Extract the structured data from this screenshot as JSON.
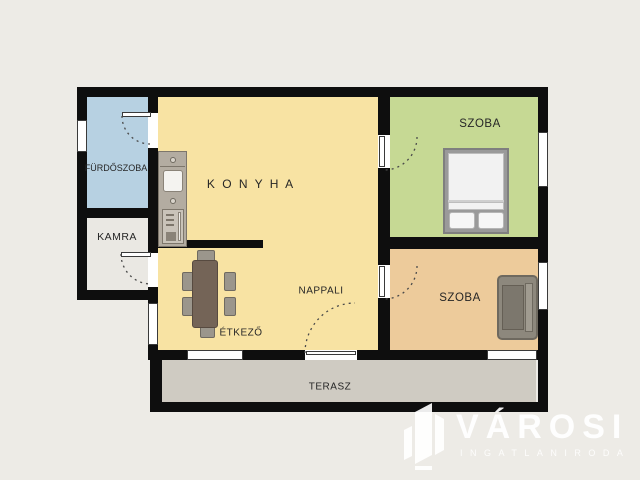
{
  "plan": {
    "type": "apartment-floorplan",
    "background_color": "#edebe6",
    "wall_color": "#0e0e0e",
    "rooms": [
      {
        "id": "furdoszoba",
        "label": "FÜRDŐSZOBA",
        "color": "#b7d1e2"
      },
      {
        "id": "kamra",
        "label": "KAMRA",
        "color": "#eae8e3"
      },
      {
        "id": "konyha",
        "label": "K O N Y H A",
        "color": "#f8e3a3"
      },
      {
        "id": "etkezo",
        "label": "ÉTKEZŐ",
        "color": "#f8e3a3"
      },
      {
        "id": "nappali",
        "label": "NAPPALI",
        "color": "#f8e3a3"
      },
      {
        "id": "szoba-green",
        "label": "SZOBA",
        "color": "#c6d994"
      },
      {
        "id": "szoba-tan",
        "label": "SZOBA",
        "color": "#edcb9b"
      },
      {
        "id": "terasz",
        "label": "TERASZ",
        "color": "#cfcbc2"
      }
    ],
    "furniture": [
      {
        "id": "kitchen-counter",
        "room": "konyha"
      },
      {
        "id": "dining-table-with-chairs",
        "room": "etkezo"
      },
      {
        "id": "double-bed",
        "room": "szoba-green"
      },
      {
        "id": "sofa",
        "room": "szoba-tan"
      }
    ],
    "openings": {
      "windows": 6,
      "doors": 5
    }
  },
  "watermark": {
    "brand": "VÁROSI",
    "tagline": "INGATLANIRODA",
    "icon": "building-logo",
    "color": "#ffffff"
  }
}
